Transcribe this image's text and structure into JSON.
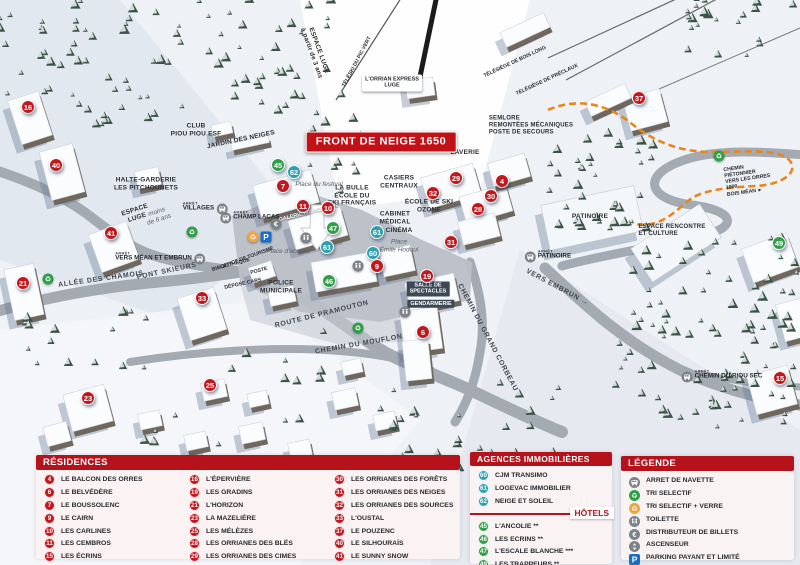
{
  "banner": {
    "title": "FRONT DE NEIGE 1650"
  },
  "colors": {
    "header_red": "#b5121b",
    "marker_red": "#c4171d",
    "marker_teal": "#2fa0ae",
    "marker_green": "#2f9e49",
    "icon_gray": "#7d8288",
    "icon_orange": "#f2a33c",
    "icon_green": "#2f9e49",
    "parking_blue": "#1a6fc4",
    "path_orange": "#e8861a"
  },
  "map": {
    "markers": [
      {
        "n": "16",
        "c": "red",
        "x": 28,
        "y": 107
      },
      {
        "n": "40",
        "c": "red",
        "x": 56,
        "y": 165
      },
      {
        "n": "21",
        "c": "red",
        "x": 23,
        "y": 283
      },
      {
        "n": "41",
        "c": "red",
        "x": 111,
        "y": 233
      },
      {
        "n": "33",
        "c": "red",
        "x": 202,
        "y": 298
      },
      {
        "n": "23",
        "c": "red",
        "x": 88,
        "y": 398
      },
      {
        "n": "25",
        "c": "red",
        "x": 210,
        "y": 385
      },
      {
        "n": "7",
        "c": "red",
        "x": 283,
        "y": 186
      },
      {
        "n": "45",
        "c": "green",
        "x": 278,
        "y": 165
      },
      {
        "n": "62",
        "c": "teal",
        "x": 294,
        "y": 172
      },
      {
        "n": "11",
        "c": "red",
        "x": 303,
        "y": 206
      },
      {
        "n": "10",
        "c": "red",
        "x": 328,
        "y": 208
      },
      {
        "n": "47",
        "c": "green",
        "x": 333,
        "y": 228
      },
      {
        "n": "61",
        "c": "teal",
        "x": 327,
        "y": 247
      },
      {
        "n": "61",
        "c": "teal",
        "x": 377,
        "y": 232
      },
      {
        "n": "60",
        "c": "teal",
        "x": 373,
        "y": 253
      },
      {
        "n": "9",
        "c": "red",
        "x": 377,
        "y": 266
      },
      {
        "n": "46",
        "c": "green",
        "x": 329,
        "y": 281
      },
      {
        "n": "29",
        "c": "red",
        "x": 456,
        "y": 178
      },
      {
        "n": "32",
        "c": "red",
        "x": 433,
        "y": 193
      },
      {
        "n": "4",
        "c": "red",
        "x": 502,
        "y": 181
      },
      {
        "n": "30",
        "c": "red",
        "x": 491,
        "y": 196
      },
      {
        "n": "28",
        "c": "red",
        "x": 478,
        "y": 209
      },
      {
        "n": "31",
        "c": "red",
        "x": 451,
        "y": 242
      },
      {
        "n": "19",
        "c": "red",
        "x": 427,
        "y": 276
      },
      {
        "n": "6",
        "c": "red",
        "x": 423,
        "y": 332
      },
      {
        "n": "37",
        "c": "red",
        "x": 639,
        "y": 98
      },
      {
        "n": "49",
        "c": "green",
        "x": 779,
        "y": 243
      },
      {
        "n": "15",
        "c": "red",
        "x": 780,
        "y": 378
      }
    ],
    "labels": [
      {
        "t": "ESPACE LUGE\nà partir de 3 ans",
        "x": 315,
        "y": 52,
        "r": 70,
        "s": "poi"
      },
      {
        "t": "TÉLÉSKI DU PIC VERT",
        "x": 357,
        "y": 62,
        "r": -62,
        "s": "tiny"
      },
      {
        "t": "L'ORRIAN EXPRESS\nLUGE",
        "x": 392,
        "y": 83,
        "r": 0,
        "s": "wbox"
      },
      {
        "t": "TÉLÉSIÈGE DE BOIS LONG",
        "x": 515,
        "y": 62,
        "r": -25,
        "s": "tiny"
      },
      {
        "t": "TÉLÉSIÈGE DE PRÉCLAUX",
        "x": 547,
        "y": 80,
        "r": -25,
        "s": "tiny"
      },
      {
        "t": "SEMLORE\nREMONTÉES MÉCANIQUES\nPOSTE DE SECOURS",
        "x": 531,
        "y": 126,
        "r": 0,
        "s": "poi-l"
      },
      {
        "t": "CLUB\nPIOU PIOU ESF",
        "x": 196,
        "y": 130,
        "r": 0,
        "s": "poi"
      },
      {
        "t": "JARDIN DES NEIGES",
        "x": 241,
        "y": 140,
        "r": -12,
        "s": "poi"
      },
      {
        "t": "HALTE-GARDERIE\nLES PITCHOUNETS",
        "x": 146,
        "y": 184,
        "r": 0,
        "s": "poi"
      },
      {
        "t": "ESPACE\nLUGE",
        "x": 136,
        "y": 214,
        "r": -18,
        "s": "poi"
      },
      {
        "t": "moins\nde 6 ans",
        "x": 158,
        "y": 216,
        "r": -18,
        "s": "place"
      },
      {
        "t": "ALLÉE DES CHAMOIS",
        "x": 101,
        "y": 280,
        "r": -8,
        "s": "road"
      },
      {
        "t": "PONT SKIEURS",
        "x": 167,
        "y": 272,
        "r": -12,
        "s": "road"
      },
      {
        "t": "OFFICE DE TOURISME",
        "x": 247,
        "y": 258,
        "r": -20,
        "s": "tiny"
      },
      {
        "t": "BIBLIOTHÈQUE",
        "x": 231,
        "y": 265,
        "r": -15,
        "s": "tiny"
      },
      {
        "t": "POSTE",
        "x": 259,
        "y": 271,
        "r": -15,
        "s": "tiny"
      },
      {
        "t": "DÉPOSE CARS",
        "x": 243,
        "y": 284,
        "r": -12,
        "s": "tiny"
      },
      {
        "t": "POLICE\nMUNICIPALE",
        "x": 281,
        "y": 287,
        "r": 0,
        "s": "poi"
      },
      {
        "t": "Place d'accueil",
        "x": 288,
        "y": 252,
        "r": 0,
        "s": "place"
      },
      {
        "t": "Place du festival",
        "x": 319,
        "y": 185,
        "r": 0,
        "s": "place"
      },
      {
        "t": "GALERIE MARCHANDE",
        "x": 309,
        "y": 213,
        "r": -14,
        "s": "white"
      },
      {
        "t": "LA BULLE\nÉCOLE DU\nSKI FRANÇAIS",
        "x": 352,
        "y": 196,
        "r": 0,
        "s": "poi"
      },
      {
        "t": "CASIERS\nCENTRAUX",
        "x": 399,
        "y": 182,
        "r": 0,
        "s": "poi"
      },
      {
        "t": "ÉCOLE DE SKI\nOZONE",
        "x": 429,
        "y": 206,
        "r": 0,
        "s": "poi"
      },
      {
        "t": "CABINET\nMÉDICAL",
        "x": 395,
        "y": 218,
        "r": 0,
        "s": "poi"
      },
      {
        "t": "CINÉMA",
        "x": 399,
        "y": 231,
        "r": 0,
        "s": "poi"
      },
      {
        "t": "Place\nÉmile Hodoul",
        "x": 399,
        "y": 246,
        "r": 0,
        "s": "place"
      },
      {
        "t": "LAVERIE",
        "x": 465,
        "y": 153,
        "r": 0,
        "s": "poi"
      },
      {
        "t": "SALLE DE\nSPECTACLES",
        "x": 428,
        "y": 289,
        "r": 0,
        "s": "dark"
      },
      {
        "t": "GENDARMERIE",
        "x": 431,
        "y": 304,
        "r": 0,
        "s": "dark"
      },
      {
        "t": "PATINOIRE",
        "x": 590,
        "y": 217,
        "r": 0,
        "s": "poi"
      },
      {
        "t": "ESPACE RENCONTRE\nET CULTURE",
        "x": 672,
        "y": 231,
        "r": 0,
        "s": "poi-l"
      },
      {
        "t": "VERS EMBRUN →",
        "x": 557,
        "y": 288,
        "r": 28,
        "s": "road"
      },
      {
        "t": "ROUTE DE PRAMOUTON",
        "x": 322,
        "y": 315,
        "r": -14,
        "s": "road"
      },
      {
        "t": "CHEMIN DU MOUFLON",
        "x": 359,
        "y": 345,
        "r": -10,
        "s": "road"
      },
      {
        "t": "CHEMIN DU GRAND CORBEAU",
        "x": 487,
        "y": 338,
        "r": 62,
        "s": "road"
      },
      {
        "t": "CHEMIN PIÉTONNIER\nVERS LES ORRES 1800\nBOIS MÉAN ►",
        "x": 750,
        "y": 179,
        "r": -8,
        "s": "tiny"
      }
    ],
    "stops": [
      {
        "label": "VILLAGES",
        "arret": "ARRÊT",
        "x": 205,
        "y": 207,
        "side": "right"
      },
      {
        "label": "CHAMP LACAS",
        "arret": "ARRÊT",
        "x": 250,
        "y": 216,
        "side": "left"
      },
      {
        "label": "VERS MÉAN ET EMBRUN",
        "arret": "ARRÊT",
        "x": 160,
        "y": 257,
        "side": "right"
      },
      {
        "label": "PATINOIRE",
        "arret": "ARRÊT",
        "x": 548,
        "y": 255,
        "side": "left"
      },
      {
        "label": "CHEMIN DU RIOU SEC",
        "arret": "ARRÊT",
        "x": 722,
        "y": 375,
        "side": "left"
      }
    ],
    "icons": [
      {
        "type": "euro",
        "x": 276,
        "y": 224
      },
      {
        "type": "recycle-verre",
        "x": 253,
        "y": 237
      },
      {
        "type": "parking",
        "x": 266,
        "y": 237
      },
      {
        "type": "toilet",
        "x": 306,
        "y": 238
      },
      {
        "type": "toilet",
        "x": 358,
        "y": 266
      },
      {
        "type": "toilet",
        "x": 405,
        "y": 312
      },
      {
        "type": "recycle",
        "x": 48,
        "y": 279
      },
      {
        "type": "recycle",
        "x": 192,
        "y": 232
      },
      {
        "type": "recycle",
        "x": 358,
        "y": 328
      },
      {
        "type": "recycle",
        "x": 719,
        "y": 156
      }
    ]
  },
  "panels": {
    "residences": {
      "title": "RÉSIDENCES",
      "items": [
        {
          "n": "4",
          "label": "LE BALCON DES ORRES"
        },
        {
          "n": "6",
          "label": "LE BELVÉDÈRE"
        },
        {
          "n": "7",
          "label": "LE BOUSSOLENC"
        },
        {
          "n": "9",
          "label": "LE CAIRN"
        },
        {
          "n": "10",
          "label": "LES CARLINES"
        },
        {
          "n": "11",
          "label": "LES CEMBROS"
        },
        {
          "n": "15",
          "label": "LES ÉCRINS"
        },
        {
          "n": "16",
          "label": "L'ÉPERVIÈRE"
        },
        {
          "n": "19",
          "label": "LES GRADINS"
        },
        {
          "n": "21",
          "label": "L'HORIZON"
        },
        {
          "n": "23",
          "label": "LA MAZELIÈRE"
        },
        {
          "n": "25",
          "label": "LES MÉLÈZES"
        },
        {
          "n": "28",
          "label": "LES ORRIANES DES BLÉS"
        },
        {
          "n": "29",
          "label": "LES ORRIANES DES CIMES"
        },
        {
          "n": "30",
          "label": "LES ORRIANES DES FORÊTS"
        },
        {
          "n": "31",
          "label": "LES ORRIANES DES NEIGES"
        },
        {
          "n": "32",
          "label": "LES ORRIANES DES SOURCES"
        },
        {
          "n": "33",
          "label": "L'OUSTAL"
        },
        {
          "n": "37",
          "label": "LE POUZENC"
        },
        {
          "n": "40",
          "label": "LE SILHOURAÏS"
        },
        {
          "n": "41",
          "label": "LE SUNNY SNOW"
        }
      ]
    },
    "agences": {
      "title": "AGENCES IMMOBILIÈRES",
      "items": [
        {
          "n": "60",
          "label": "CJM TRANSIMO"
        },
        {
          "n": "61",
          "label": "LOGEVAC IMMOBILIER"
        },
        {
          "n": "62",
          "label": "NEIGE ET SOLEIL"
        }
      ]
    },
    "hotels": {
      "title": "HÔTELS",
      "items": [
        {
          "n": "45",
          "label": "L'ANCOLIE **"
        },
        {
          "n": "46",
          "label": "LES ECRINS **"
        },
        {
          "n": "47",
          "label": "L'ESCALE BLANCHE ***"
        },
        {
          "n": "49",
          "label": "LES TRAPPEURS **"
        }
      ]
    },
    "legende": {
      "title": "LÉGENDE",
      "items": [
        {
          "icon": "bus",
          "label": "ARRET DE NAVETTE"
        },
        {
          "icon": "recycle",
          "label": "TRI SELECTIF"
        },
        {
          "icon": "recycle-verre",
          "label": "TRI SELECTIF + VERRE"
        },
        {
          "icon": "toilet",
          "label": "TOILETTE"
        },
        {
          "icon": "euro",
          "label": "DISTRIBUTEUR DE BILLETS"
        },
        {
          "icon": "elevator",
          "label": "ASCENSEUR"
        },
        {
          "icon": "parking",
          "label": "PARKING PAYANT ET LIMITÉ"
        }
      ]
    }
  }
}
